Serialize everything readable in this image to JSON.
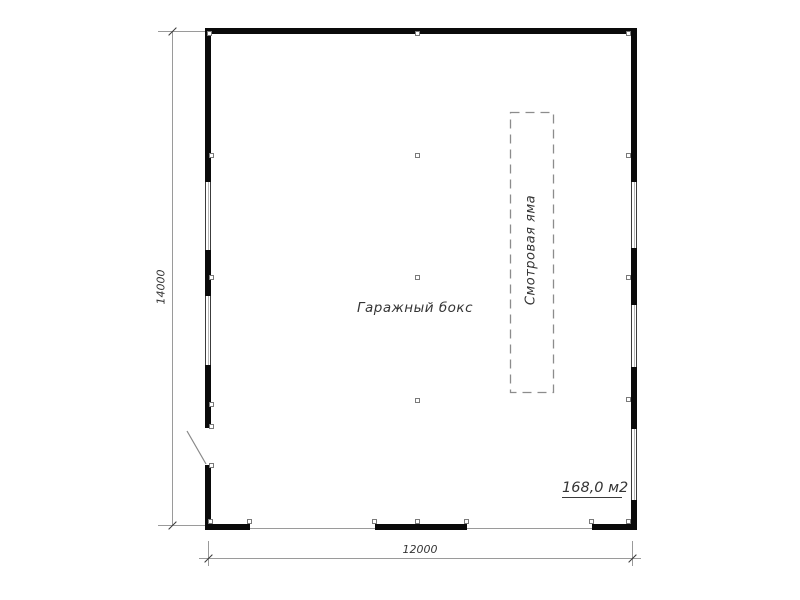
{
  "labels": {
    "room": "Гаражный бокс",
    "pit": "Смотровая яма",
    "area": "168,0 м2",
    "dim_vertical": "14000",
    "dim_horizontal": "12000"
  },
  "colors": {
    "wall": "#0a0a0a",
    "thin_line": "#9a9a9a",
    "dashed_line": "#8c8c8c",
    "text": "#353535",
    "background": "#ffffff"
  }
}
